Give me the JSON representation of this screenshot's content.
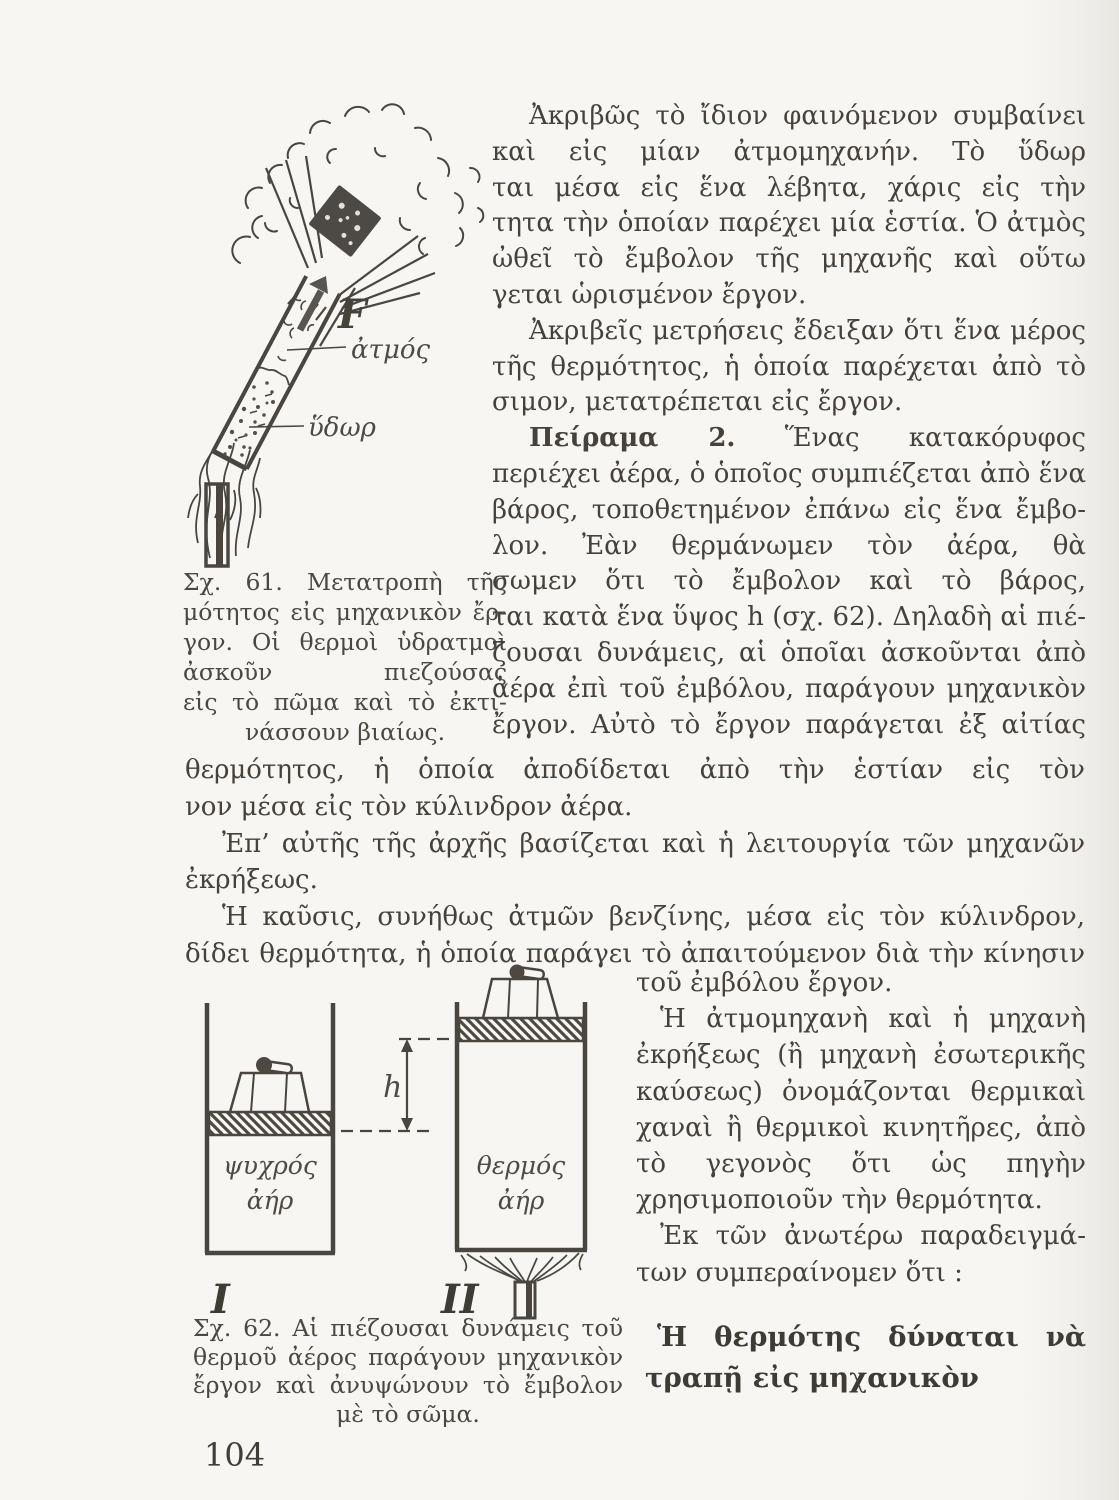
{
  "colors": {
    "paper": "#f7f6f2",
    "ink": "#46413b"
  },
  "page": {
    "number": "104"
  },
  "body": {
    "p1": [
      "Ἀκριβῶς τὸ ἴδιον φαινόμενον συμβαίνει",
      "καὶ εἰς μίαν ἀτμομηχανήν. Τὸ ὕδωρ ἀτμοποιεῖ-",
      "ται μέσα εἰς ἕνα λέβητα, χάρις εἰς τὴν θερμό-",
      "τητα τὴν ὁποίαν παρέχει μία ἑστία. Ὁ ἀτμὸς",
      "ὠθεῖ τὸ ἔμβολον τῆς μηχανῆς καὶ οὕτω παρά-",
      "γεται ὡρισμένον ἔργον."
    ],
    "p2": [
      "Ἀκριβεῖς μετρήσεις ἔδειξαν ὅτι ἕνα μέρος",
      "τῆς θερμότητος, ἡ ὁποία παρέχεται ἀπὸ τὸ καύ-",
      "σιμον, μετατρέπεται εἰς ἔργον."
    ],
    "p3_bold": "Πείραμα 2.",
    "p3_first": "Ἕνας κατακόρυφος κύλινδρος",
    "p3": [
      "περιέχει ἀέρα, ὁ ὁποῖος συμπιέζεται ἀπὸ ἕνα",
      "βάρος, τοποθετημένον ἐπάνω εἰς ἕνα ἔμβο-",
      "λον. Ἐὰν θερμάνωμεν τὸν ἀέρα, θὰ παρατηρή-",
      "σωμεν ὅτι τὸ ἔμβολον καὶ τὸ βάρος, ὑψώνον-",
      "ται κατὰ ἕνα ὕψος h (σχ. 62). Δηλαδὴ αἱ πιέ-",
      "ζουσαι δυνάμεις, αἱ ὁποῖαι ἀσκοῦνται ἀπὸ τὸν",
      "ἀέρα ἐπὶ τοῦ ἐμβόλου, παράγουν μηχανικὸν",
      "ἔργον. Αὐτὸ τὸ ἔργον παράγεται ἐξ αἰτίας τῆς"
    ],
    "full": [
      "θερμότητος, ἡ ὁποία ἀποδίδεται ἀπὸ τὴν ἑστίαν εἰς τὸν περιωρισμέ-",
      "νον μέσα εἰς τὸν κύλινδρον ἀέρα."
    ],
    "p4": [
      "Ἐπ’ αὐτῆς τῆς ἀρχῆς βασίζεται καὶ ἡ λειτουργία τῶν μηχανῶν",
      "ἐκρήξεως."
    ],
    "p5": [
      "Ἡ καῦσις, συνήθως ἀτμῶν βενζίνης, μέσα εἰς τὸν κύλινδρον, ἀπο-",
      "δίδει θερμότητα, ἡ ὁποία παράγει τὸ ἀπαιτούμενον διὰ τὴν κίνησιν"
    ],
    "col2": [
      "τοῦ ἐμβόλου ἔργον.",
      "Ἡ ἀτμομηχανὴ καὶ ἡ μηχανὴ",
      "ἐκρήξεως (ἢ μηχανὴ ἐσωτερικῆς",
      "καύσεως) ὀνομάζονται θερμικαὶ μη-",
      "χαναὶ ἢ θερμικοὶ κινητῆρες, ἀπὸ",
      "τὸ γεγονὸς ὅτι ὡς πηγὴν ἐνεργείας",
      "χρησιμοποιοῦν τὴν θερμότητα.",
      "Ἐκ τῶν ἀνωτέρω παραδειγμά-",
      "των συμπεραίνομεν ὅτι :"
    ],
    "conclusion": [
      "Ἡ θερμότης  δύναται  νὰ  μετα-",
      "τραπῇ εἰς μηχανικὸν ἔργον."
    ]
  },
  "fig61": {
    "labels": {
      "force": "F",
      "steam": "ἀτμός",
      "water": "ὕδωρ"
    },
    "caption": [
      "Σχ. 61. Μετατροπὴ τῆς θερ-",
      "μότητος εἰς μηχανικὸν ἔρ-",
      "γον. Οἱ θερμοὶ ὑδρατμοὶ",
      "ἀσκοῦν πιεζούσας δυνάμεις",
      "εἰς τὸ πῶμα καὶ τὸ ἐκτι-",
      "νάσσουν βιαίως."
    ]
  },
  "fig62": {
    "labels": {
      "height": "h",
      "cold_air_1": "ψυχρός",
      "cold_air_2": "ἀήρ",
      "hot_air_1": "θερμός",
      "hot_air_2": "ἀήρ",
      "numeral_1": "I",
      "numeral_2": "II"
    },
    "caption": [
      "Σχ. 62. Αἱ πιέζουσαι δυνάμεις τοῦ",
      "θερμοῦ ἀέρος παράγουν μηχανικὸν",
      "ἔργον καὶ  ἀνυψώνουν τὸ ἔμβολον",
      "μὲ τὸ σῶμα."
    ]
  }
}
